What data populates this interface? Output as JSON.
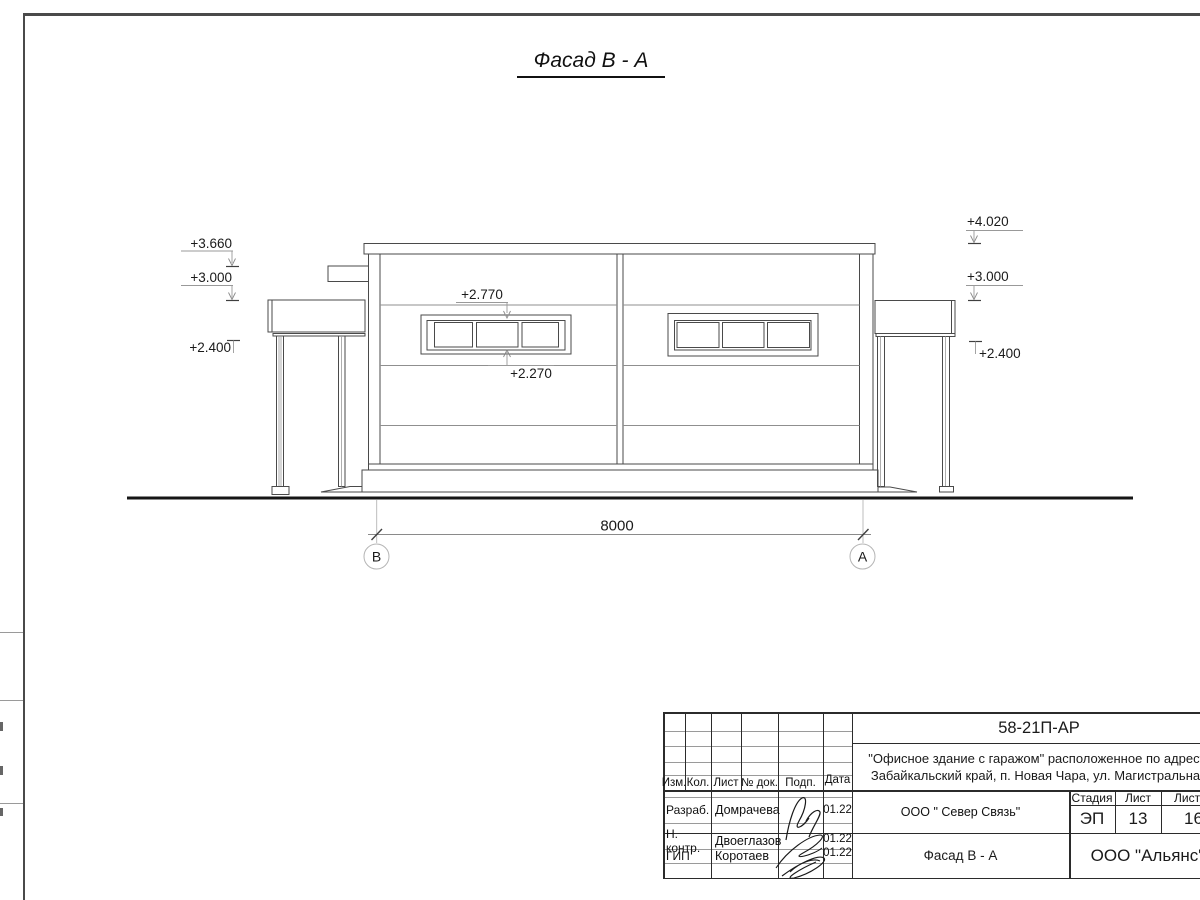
{
  "drawing": {
    "title": "Фасад В - А",
    "marks": {
      "left": [
        "+3.660",
        "+3.000",
        "+2.400"
      ],
      "right": [
        "+4.020",
        "+3.000",
        "+2.400"
      ],
      "window_top": "+2.770",
      "window_bottom": "+2.270"
    },
    "dimension_value": "8000",
    "axis_b": "В",
    "axis_a": "А"
  },
  "title_block": {
    "doc_code": "58-21П-АР",
    "project_line1": "\"Офисное здание с гаражом\" расположенное по адресу:",
    "project_line2": "Забайкальский край, п. Новая Чара, ул. Магистральная",
    "columns": {
      "izm": "Изм.",
      "kol": "Кол.",
      "list": "Лист",
      "doc": "№ док.",
      "podp": "Подп.",
      "data": "Дата"
    },
    "roles": {
      "developer_label": "Разраб.",
      "developer_name": "Домрачева",
      "developer_date": "01.22",
      "ncontrol_label": "Н. контр.",
      "ncontrol_name": "Двоеглазов",
      "ncontrol_date": "01.22",
      "gip_label": "ГИП",
      "gip_name": "Коротаев",
      "gip_date": "01.22"
    },
    "customer_org": "ООО \" Север Связь\"",
    "sheet_name": "Фасад В - А",
    "stage_label": "Стадия",
    "list_label": "Лист",
    "listov_label": "Листов",
    "stage_value": "ЭП",
    "list_value": "13",
    "listov_value": "16",
    "designer_org": "ООО \"Альянс\""
  }
}
